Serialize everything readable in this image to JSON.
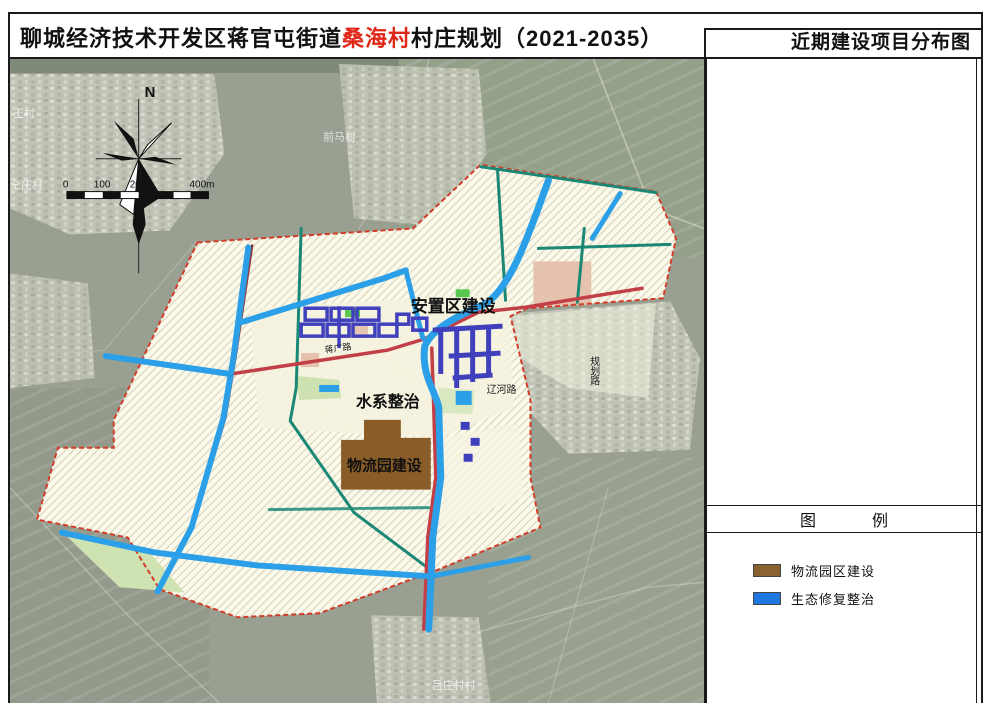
{
  "header": {
    "title_prefix": "聊城经济技术开发区蒋官屯街道",
    "title_highlight": "桑海村",
    "title_suffix": "村庄规划（2021-2035）",
    "subtitle": "近期建设项目分布图"
  },
  "map": {
    "north_label": "N",
    "scale_ticks": [
      "0",
      "100",
      "200",
      "400m"
    ],
    "projects": {
      "resettlement": "安置区建设",
      "water": "水系整治",
      "logistics": "物流园建设"
    },
    "roads": {
      "jiangguang": "蒋广路",
      "liaohe": "辽河路",
      "guihua": "规划路"
    },
    "villages": {
      "top": "前马村",
      "left_top": "王村",
      "left": "仝庄村",
      "bottom": "吕庄村村"
    }
  },
  "legend": {
    "title_char1": "图",
    "title_char2": "例",
    "items": [
      {
        "label": "物流园区建设",
        "color": "#8a6230"
      },
      {
        "label": "生态修复整治",
        "color": "#1e78e0"
      }
    ]
  },
  "colors": {
    "boundary_red": "#d23c2a",
    "river_blue": "#2ba0e8",
    "road_teal": "#1b8876",
    "road_crimson": "#c23f47",
    "building_purple": "#4040bd",
    "logistics_brown": "#8a5d28",
    "plan_cream": "#fbf9ea",
    "satellite_base": "#9aa091"
  }
}
